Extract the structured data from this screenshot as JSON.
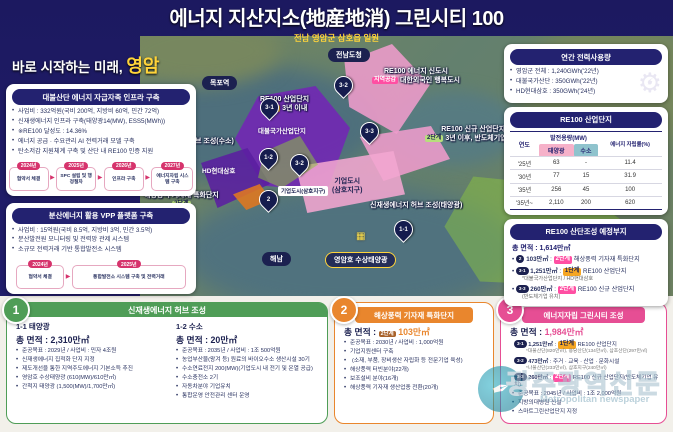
{
  "tokens": {
    "colon": ":",
    "arrow": "▶",
    "star2": "※",
    "open": "(",
    "close": ")"
  },
  "header": {
    "title": "에너지 지산지소(地産地消) 그린시티 100",
    "subtitle": "전남 영암군 삼호읍 일원"
  },
  "slogan": {
    "prefix": "바로 시작하는 미래, ",
    "highlight": "영암"
  },
  "left": {
    "infra": {
      "title": "대불산단 에너지 자급자족 인프라 구축",
      "bullets": [
        "사업비 : 332억원(국비 200억, 지방비 60억, 민간 72억)",
        "신재생에너지 인프라 구축(태양광14(MW), ESS5(MWh))",
        "※RE100 달성도 : 14.36%",
        "에너지 공급 · 수요관리 AI 전력거래 모델 구축",
        "탄소저감 지원체계 구축 및 산단 내 RE100 인증 지원"
      ],
      "timeline": [
        {
          "year": "2024년",
          "label": "협약서 체결"
        },
        {
          "year": "2025년",
          "label": "SPC 설립 및 행정절차"
        },
        {
          "year": "2026년",
          "label": "인프라 구축"
        },
        {
          "year": "2027년",
          "label": "에너지자립 시스템 구축"
        }
      ]
    },
    "vpp": {
      "title": "분산에너지 활용 VPP 플랫폼 구축",
      "bullets": [
        "사업비 : 15억원(국비 8.5억, 지방비 3억, 민간 3.5억)",
        "분산발전원 모니터링 및 전력망 관제 시스템",
        "소규모 전력거래 기반 통합발전소 시스템"
      ],
      "timeline": [
        {
          "year": "2024년",
          "label": "협약서 체결"
        },
        {
          "year": "2025년",
          "label": "통합발전소 시스템 구축 및 전력거래"
        }
      ]
    }
  },
  "right": {
    "power": {
      "title": "연간 전력사용량",
      "bullets": [
        "영암군 전체 : 1,240GWh('22년)",
        "대불국가산단 : 350GWh('22년)",
        "HD현대삼호 : 350GWh('24년)"
      ]
    },
    "re100": {
      "title": "RE100 산업단지",
      "col_year": "연도",
      "col_capacity": "발전용량(MW)",
      "col_solar": "태양광",
      "col_h2": "수소",
      "col_rate": "에너지 자립률(%)",
      "rows": [
        {
          "year": "'25년",
          "solar": "63",
          "h2": "-",
          "rate": "11.4"
        },
        {
          "year": "'30년",
          "solar": "77",
          "h2": "15",
          "rate": "31.9"
        },
        {
          "year": "'35년",
          "solar": "256",
          "h2": "45",
          "rate": "100"
        },
        {
          "year": "'35년~",
          "solar": "2,110",
          "h2": "200",
          "rate": "620"
        }
      ]
    },
    "site": {
      "title": "RE100 산단조성 예정부지",
      "total": "총 면적 : 1,614만㎡",
      "items": [
        {
          "badge": "2",
          "area": "103만㎡",
          "stage": "2단계",
          "desc": "해상풍력 기자재 특화단지",
          "note": ""
        },
        {
          "badge": "3-1",
          "area": "1,251만㎡",
          "stage": "1단계",
          "desc": "RE100 산업단지",
          "note": "*대불국가산업단지 / HD현대삼호"
        },
        {
          "badge": "3-3",
          "area": "260만㎡",
          "stage": "2단계",
          "desc": "RE100 신규 산업단지",
          "note": "(반도체기업 유치)"
        }
      ]
    }
  },
  "map": {
    "places": {
      "mokpo": "목포역",
      "jeonnam": "전남도청",
      "haenam": "해남",
      "lake": "영암호 수상태양광"
    },
    "pins": {
      "p31": "3-1",
      "p32": "3-2",
      "p33": "3-3",
      "p11": "1-1",
      "p12": "1-2",
      "p2": "2",
      "p32b": "3-2"
    },
    "newcity": {
      "line1": "RE100 에너지 신도시",
      "chip": "지역공감",
      "line2": "대한외국인 행복도시"
    },
    "indus": {
      "line1": "RE100 산업단지",
      "chip": "1단계",
      "line2": "3년 이내"
    },
    "newindus": {
      "line1": "RE100 신규 산업단지",
      "chip": "2단계",
      "line2": "3년 이후, 반도체기업 유치"
    },
    "hub_h2": "신재생에너지 허브 조성(수소)",
    "hub_solar": "신재생에너지 허브 조성(태양광)",
    "wind": {
      "line1": "해상풍력 기자재 특화단지",
      "chip": "2단계"
    },
    "daebul": "대불국가산업단지",
    "hd": "HD현대삼호",
    "bizcity_tag": "기업도시(삼호지구)",
    "bizcity_big": {
      "line1": "기업도시",
      "line2": "(삼호지구)"
    }
  },
  "bottom": {
    "p1": {
      "num": "1",
      "title": "신재생에너지 허브 조성",
      "solar": {
        "head": "1-1 태양광",
        "area": "총 면적 : 2,310만㎡",
        "bullets": [
          "준공목표 : 2029년 / 사업비 : 민자 4조원",
          "신재생에너지 집적화 단지 지정",
          "제도개선을 통한 지역주도에너지 기본소득 추진",
          "영암호 수상태양광 (610(MW)/610만㎡)",
          "간척지 태양광 (1,500(MW)/1,700만㎡)"
        ]
      },
      "h2": {
        "head": "1-2 수소",
        "area": "총 면적 : 20만㎡",
        "bullets": [
          "준공목표 : 2035년 / 사업비 : 1조 500억원",
          "농업부산물(왕겨 등) 원료의 바이오수소 생산시설 30기",
          "수소연료전지 200(MW)(기업도시 내 전기 및 온열 공급)",
          "수소충전소 2기",
          "자동차분야 기업유치",
          "통합운영 안전관리 센터 운영"
        ]
      }
    },
    "p2": {
      "num": "2",
      "title": "해상풍력 기자재 특화단지",
      "area_label": "총 면적 :",
      "stage": "2단계",
      "area": "103만㎡",
      "bullets": [
        "준공목표 : 2030년 / 사업비 : 1,000억원",
        "기업지원센터 구축",
        "(소재, 부품, 장비생산 자립화 등 전문기업 육성)",
        "해상풍력 터빈분야(22개)",
        "보조설비 분야(16개)",
        "해상풍력 기자재 생산업종 전환(20개)"
      ]
    },
    "p3": {
      "num": "3",
      "title": "에너지자립 그린시티 조성",
      "area_label": "총 면적 :",
      "area": "1,984만㎡",
      "items": [
        {
          "badge": "3-1",
          "area": "1,251만㎡",
          "stage": "1단계",
          "desc": "RE100 산업단지",
          "note": "*대불산단(820만㎡), 용당산단(134만㎡), 삼호산단(297만㎡)"
        },
        {
          "badge": "3-2",
          "area": "473만㎡",
          "stage": "",
          "desc": "주거 · 교육 · 산업 · 문화시설",
          "note": "*나불산단(233만㎡), 삼호지구(240만㎡)"
        },
        {
          "badge": "3-3",
          "area": "260만㎡",
          "stage": "2단계",
          "desc": "RE100 신규 산업단지(반도체기업 유치)",
          "note": ""
        }
      ],
      "bullets": [
        "준공목표 : 2045년 / 사업비 : 1조 2,000억원",
        "지방의대병원 신설",
        "스마트그린산업단지 지정"
      ]
    }
  },
  "watermark": {
    "korean": "광주광역신문",
    "latin": "Metropolitan newspaper",
    "pen_icon": "✒"
  }
}
